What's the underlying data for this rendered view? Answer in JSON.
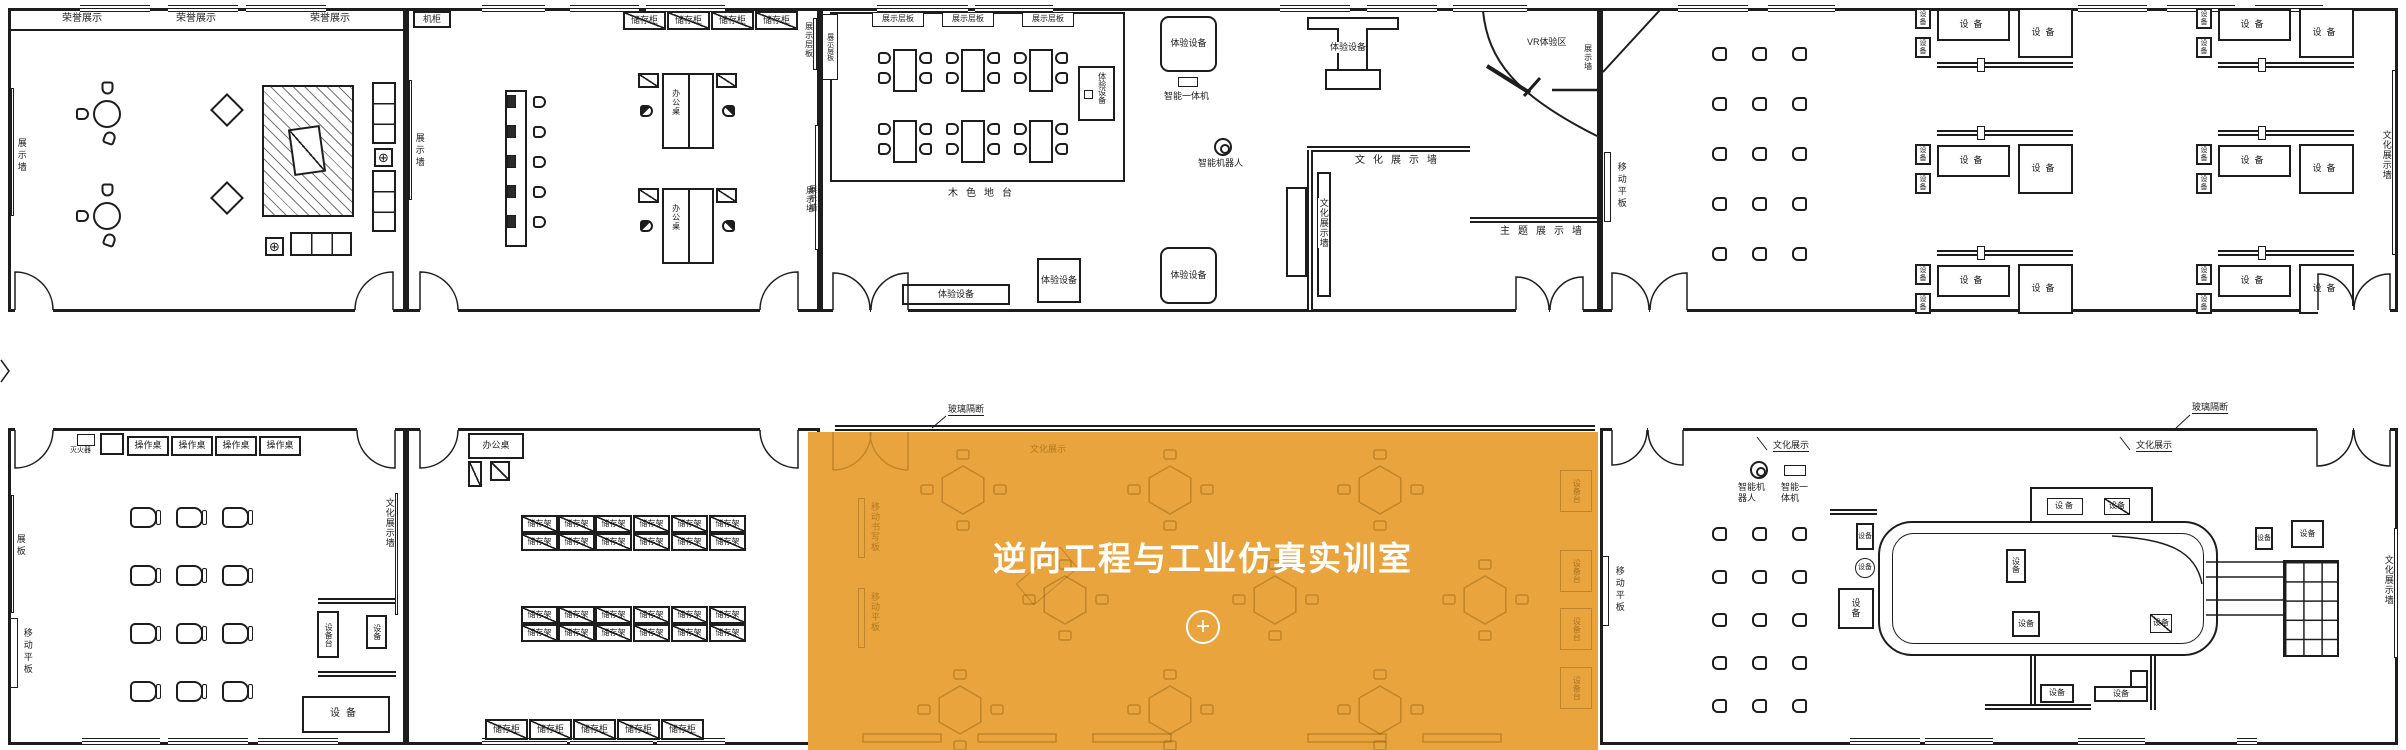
{
  "overlay": {
    "room_name": "逆向工程与工业仿真实训室",
    "accent_color": "#E9A43D"
  },
  "icons": {
    "plus": "+",
    "crosshair": "⊕"
  },
  "labels": {
    "honor": "荣誉展示",
    "display_wall": "展示墙",
    "display_board": "展板",
    "display_shelf": "展示层板",
    "server_cabinet": "机柜",
    "storage_cabinet": "储存柜",
    "storage_rack": "储存架",
    "office_desk": "办公桌",
    "operation_desk": "操作桌",
    "wood_platform": "木色地台",
    "experience_equipment": "体验设备",
    "smart_aio": "智能一体机",
    "smart_robot": "智能机器人",
    "vr_zone": "VR体验区",
    "culture_wall": "文化展示墙",
    "culture_display": "文化展示",
    "theme_wall": "主题展示墙",
    "mobile_panel": "移动平板",
    "mobile_writeboard": "移动书写板",
    "glass_partition": "玻璃隔断",
    "equipment": "设备",
    "equipment_stand": "设备台",
    "fire_extinguisher": "灭火器"
  }
}
